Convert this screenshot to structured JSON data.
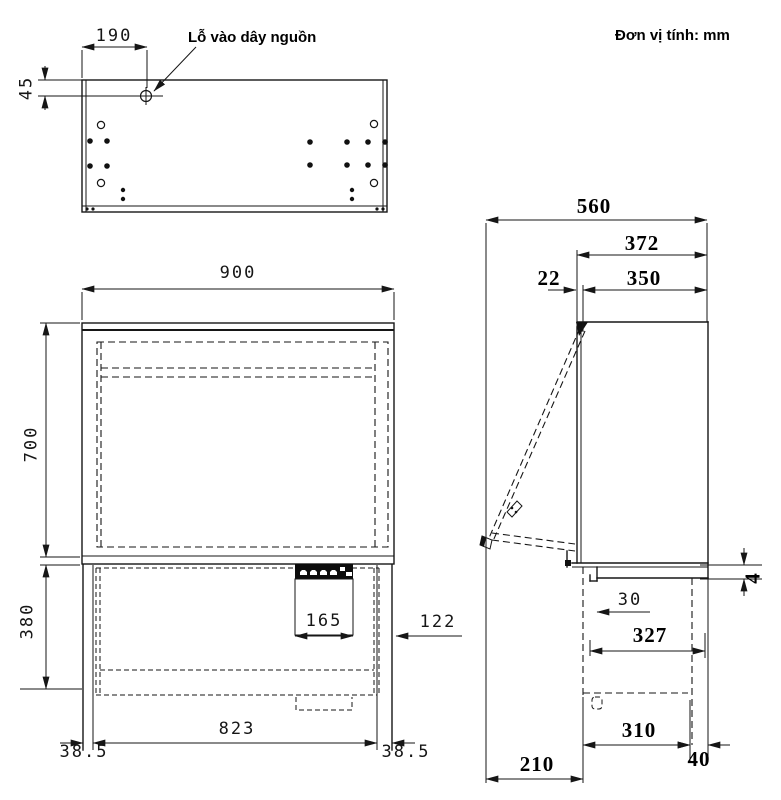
{
  "meta": {
    "unit_note": "Đơn vị tính: mm"
  },
  "top_view": {
    "power_hole_label": "Lỗ vào dây nguồn",
    "dims": {
      "hole_offset_x": "190",
      "hole_offset_y": "45"
    }
  },
  "front_view": {
    "dims": {
      "width": "900",
      "upper_height": "700",
      "lower_height": "380",
      "control_panel_width": "165",
      "control_panel_offset": "122",
      "inner_width": "823",
      "side_margin_left": "38.5",
      "side_margin_right": "38.5"
    }
  },
  "side_view": {
    "dims": {
      "total_depth_open": "560",
      "depth_372": "372",
      "door_thickness": "22",
      "body_depth": "350",
      "gap": "4",
      "front_lip": "30",
      "chassis_depth": "327",
      "base_depth": "310",
      "rear_margin": "40",
      "door_projection": "210"
    }
  }
}
